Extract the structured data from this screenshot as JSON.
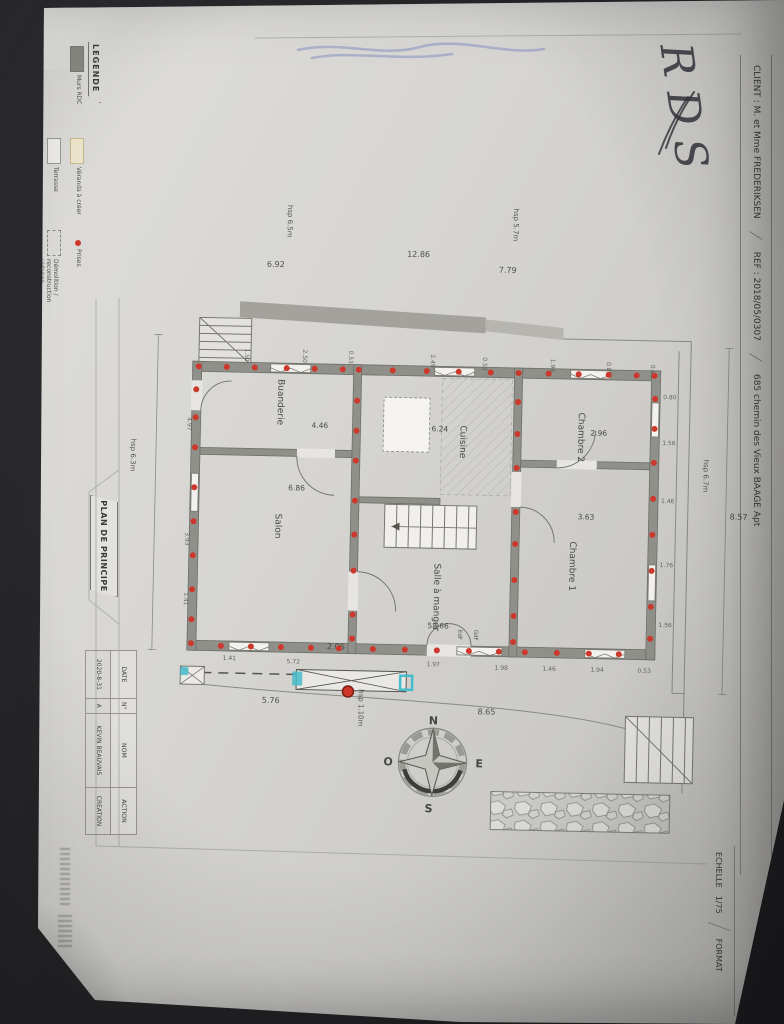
{
  "handwriting": {
    "label": "RDS"
  },
  "legend": {
    "title": "LEGENDE",
    "items": [
      {
        "label": "Murs RDC",
        "swatch": "solid"
      },
      {
        "label": "Véranda à créer",
        "swatch": "cream"
      },
      {
        "label": "Prises",
        "swatch": "dot"
      },
      {
        "label": "Terrasse",
        "swatch": "outline"
      },
      {
        "label": "Démolition / reconstruction vidange",
        "swatch": "dashed"
      }
    ]
  },
  "client_strip": {
    "client": "CLIENT : M. et Mme FREDERIKSEN",
    "ref": "REF : 2018/05/0307",
    "address": "685 chemin des Vieux BAAGE Apt",
    "separator": "/"
  },
  "scale_strip": {
    "echelle_label": "ECHELLE",
    "echelle_value": "1/75",
    "format_label": "FORMAT"
  },
  "title_block": {
    "title": "PLAN DE PRINCIPE",
    "table": {
      "headers": [
        "DATE",
        "N°",
        "NOM",
        "ACTION"
      ],
      "rows": [
        [
          "2020-8-31",
          "A",
          "KEVIN BEAUVAIS",
          "CREATION"
        ]
      ]
    }
  },
  "compass": {
    "n": "N",
    "s": "S",
    "e": "E",
    "o": "O"
  },
  "colors": {
    "paper": "#d6d5d2",
    "wall": "#90908a",
    "red_dot": "#cc392c",
    "cyan": "#45bccb",
    "blue_pencil": "#6e7dbe",
    "ink": "#34343d"
  },
  "plan": {
    "rooms": [
      {
        "name": "Buanderie",
        "area": "4.46",
        "x": 276,
        "y": 405,
        "ax": 310,
        "ay": 430
      },
      {
        "name": "Salon",
        "area": "6.86",
        "x": 276,
        "y": 529,
        "ax": 288,
        "ay": 493
      },
      {
        "name": "Cuisine",
        "area": "6.24",
        "x": 459,
        "y": 441,
        "ax": 430,
        "ay": 431
      },
      {
        "name": "Chambre 2",
        "area": "2.96",
        "x": 577,
        "y": 434,
        "ax": 589,
        "ay": 432
      },
      {
        "name": "Salle à manger",
        "area": "52.66",
        "x": 436,
        "y": 597,
        "ax": 430,
        "ay": 628
      },
      {
        "name": "Chambre 1",
        "area": "3.63",
        "x": 571,
        "y": 563,
        "ax": 578,
        "ay": 516
      }
    ],
    "annotations": [
      {
        "t": "hsp 6.5m",
        "x": 282,
        "y": 224
      },
      {
        "t": "hsp 5.7m",
        "x": 508,
        "y": 223
      },
      {
        "t": "hsp 6.3m",
        "x": 130,
        "y": 461
      },
      {
        "t": "hsp 6.7m",
        "x": 703,
        "y": 470
      },
      {
        "t": "hsp 1.10m",
        "x": 363,
        "y": 709
      },
      {
        "t": "EdF",
        "x": 461,
        "y": 634,
        "s": 5.5
      },
      {
        "t": "GdF",
        "x": 477,
        "y": 634,
        "s": 5.5
      }
    ],
    "big_dims": [
      {
        "t": "6.92",
        "x": 262,
        "y": 270
      },
      {
        "t": "12.86",
        "x": 402,
        "y": 257
      },
      {
        "t": "7.79",
        "x": 494,
        "y": 271
      },
      {
        "t": "5.76",
        "x": 266,
        "y": 706
      },
      {
        "t": "8.65",
        "x": 482,
        "y": 713
      },
      {
        "t": "8.57",
        "x": 730,
        "y": 513
      },
      {
        "t": "2.06",
        "x": 330,
        "y": 651
      }
    ],
    "wall_dims": [
      {
        "t": "1.50",
        "x": 242,
        "y": 352,
        "r": 1
      },
      {
        "t": "2.50",
        "x": 300,
        "y": 352,
        "r": 1
      },
      {
        "t": "0.53",
        "x": 346,
        "y": 352,
        "r": 1
      },
      {
        "t": "2.49",
        "x": 428,
        "y": 354,
        "r": 1
      },
      {
        "t": "0.53",
        "x": 480,
        "y": 356,
        "r": 1
      },
      {
        "t": "1.96",
        "x": 548,
        "y": 356,
        "r": 1
      },
      {
        "t": "0.80",
        "x": 604,
        "y": 358,
        "r": 1
      },
      {
        "t": "0.90",
        "x": 648,
        "y": 360,
        "r": 1
      },
      {
        "t": "0.80",
        "x": 661,
        "y": 394,
        "r": 0
      },
      {
        "t": "1.56",
        "x": 661,
        "y": 440,
        "r": 0
      },
      {
        "t": "1.46",
        "x": 661,
        "y": 498,
        "r": 0
      },
      {
        "t": "1.76",
        "x": 661,
        "y": 562,
        "r": 0
      },
      {
        "t": "1.56",
        "x": 661,
        "y": 622,
        "r": 0
      },
      {
        "t": "1.41",
        "x": 226,
        "y": 664,
        "r": 0
      },
      {
        "t": "5.72",
        "x": 290,
        "y": 666,
        "r": 0
      },
      {
        "t": "1.97",
        "x": 430,
        "y": 666,
        "r": 0
      },
      {
        "t": "1.98",
        "x": 498,
        "y": 668,
        "r": 0
      },
      {
        "t": "1.46",
        "x": 546,
        "y": 668,
        "r": 0
      },
      {
        "t": "1.94",
        "x": 594,
        "y": 668,
        "r": 0
      },
      {
        "t": "0.53",
        "x": 641,
        "y": 668,
        "r": 0
      },
      {
        "t": "4.97",
        "x": 186,
        "y": 422,
        "r": 1
      },
      {
        "t": "3.93",
        "x": 186,
        "y": 537,
        "r": 1
      },
      {
        "t": "1.41",
        "x": 186,
        "y": 597,
        "r": 1
      }
    ],
    "red_dots": [
      [
        196,
        371
      ],
      [
        224,
        371
      ],
      [
        252,
        371
      ],
      [
        284,
        371
      ],
      [
        312,
        371
      ],
      [
        340,
        371
      ],
      [
        356,
        371
      ],
      [
        390,
        371
      ],
      [
        424,
        371
      ],
      [
        456,
        371
      ],
      [
        488,
        371
      ],
      [
        516,
        371
      ],
      [
        546,
        371
      ],
      [
        576,
        371
      ],
      [
        606,
        371
      ],
      [
        634,
        371
      ],
      [
        652,
        371
      ],
      [
        194,
        394
      ],
      [
        194,
        422
      ],
      [
        194,
        452
      ],
      [
        194,
        492
      ],
      [
        194,
        526
      ],
      [
        194,
        560
      ],
      [
        194,
        594
      ],
      [
        194,
        624
      ],
      [
        194,
        648
      ],
      [
        653,
        394
      ],
      [
        653,
        424
      ],
      [
        653,
        458
      ],
      [
        653,
        494
      ],
      [
        653,
        530
      ],
      [
        653,
        566
      ],
      [
        653,
        602
      ],
      [
        653,
        634
      ],
      [
        224,
        650
      ],
      [
        254,
        650
      ],
      [
        284,
        650
      ],
      [
        314,
        650
      ],
      [
        342,
        650
      ],
      [
        376,
        650
      ],
      [
        408,
        650
      ],
      [
        440,
        650
      ],
      [
        472,
        650
      ],
      [
        502,
        650
      ],
      [
        528,
        650
      ],
      [
        560,
        650
      ],
      [
        592,
        650
      ],
      [
        622,
        650
      ],
      [
        355,
        402
      ],
      [
        355,
        432
      ],
      [
        355,
        462
      ],
      [
        355,
        502
      ],
      [
        355,
        536
      ],
      [
        355,
        572
      ],
      [
        355,
        616
      ],
      [
        355,
        640
      ],
      [
        516,
        400
      ],
      [
        516,
        432
      ],
      [
        516,
        466
      ],
      [
        516,
        510
      ],
      [
        516,
        542
      ],
      [
        516,
        578
      ],
      [
        516,
        614
      ],
      [
        516,
        640
      ]
    ]
  }
}
